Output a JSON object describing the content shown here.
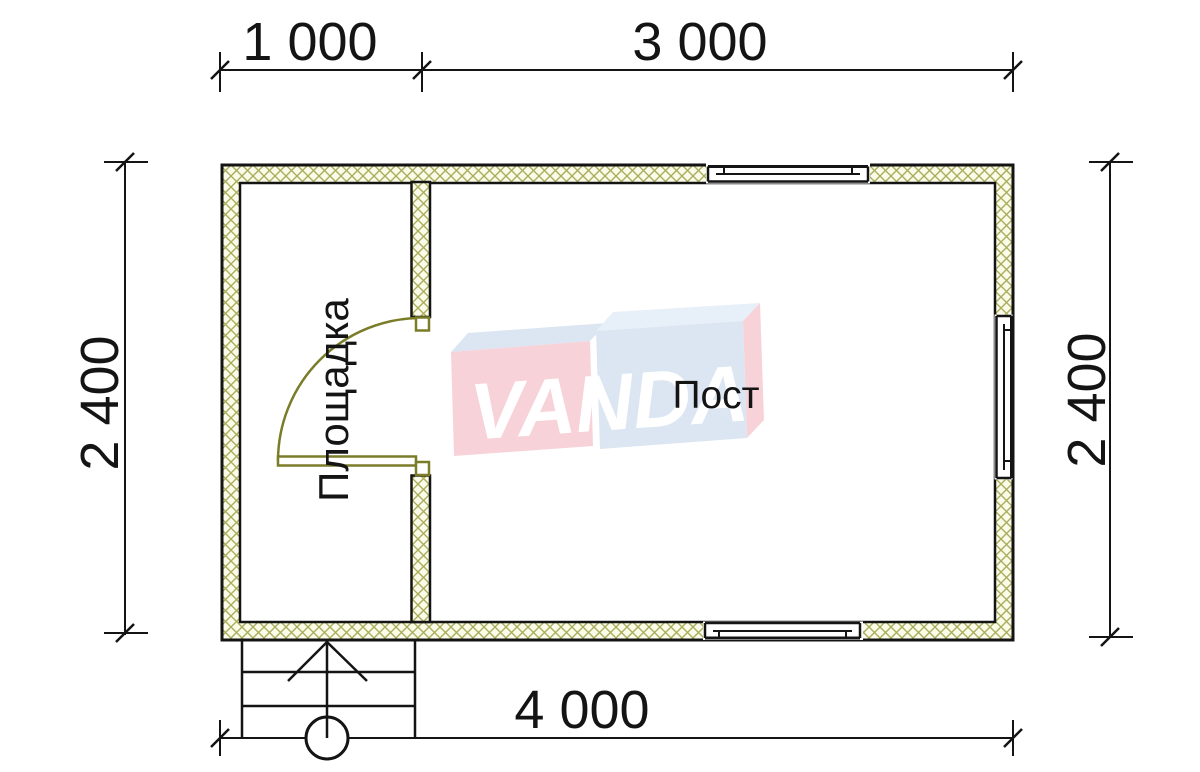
{
  "plan": {
    "dimensions": {
      "top_segment_1": "1 000",
      "top_segment_2": "3 000",
      "side_left": "2 400",
      "side_right": "2 400",
      "bottom_total": "4 000"
    },
    "rooms": {
      "entry_area_label": "Площадка",
      "main_room_label": "Пост"
    },
    "watermark": {
      "brand": "VANDA"
    },
    "colors": {
      "line": "#141414",
      "wall_hatch_line": "#a9ad5c",
      "wall_hatch_bg": "#fbfbe9",
      "door": "#7a7c28",
      "logo_pink": "#f8d2d9",
      "logo_blue": "#dbe6f2",
      "logo_blue_light": "#e7eff8",
      "logo_text": "#ffffff"
    }
  }
}
